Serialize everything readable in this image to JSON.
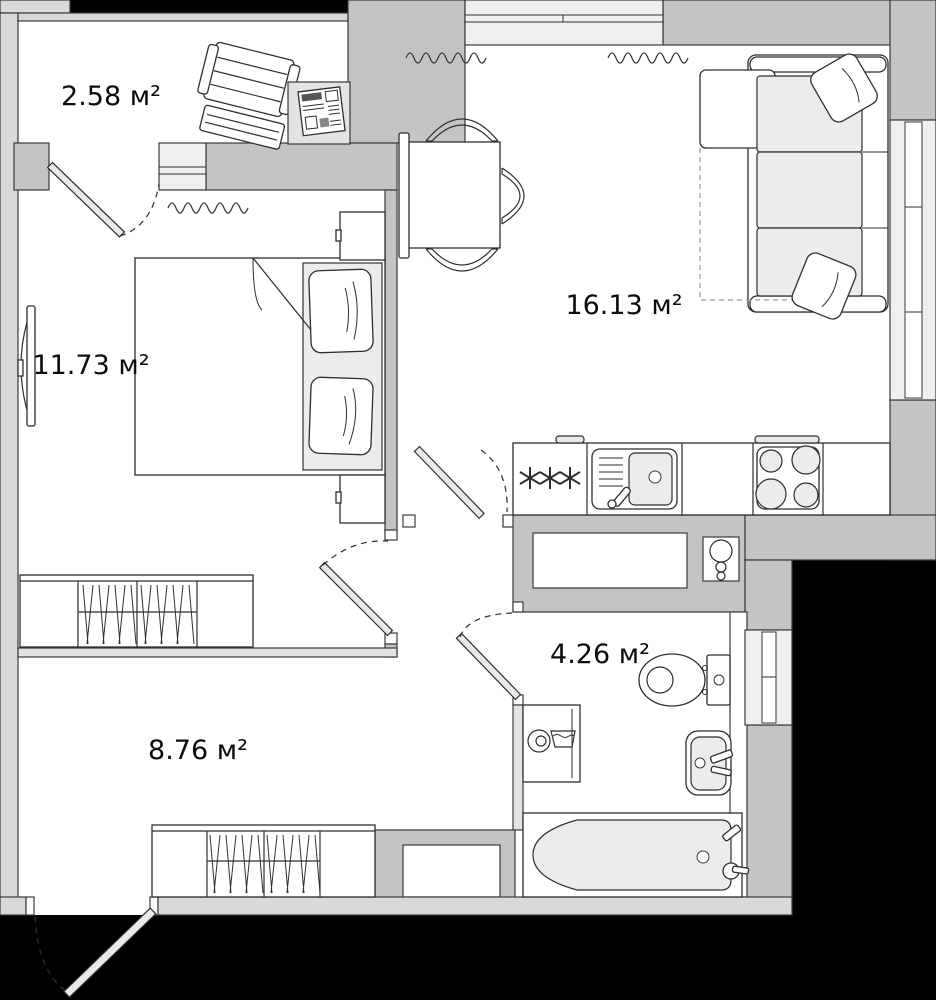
{
  "plan": {
    "type": "apartment-floor-plan",
    "unit": "м²",
    "rooms": [
      {
        "name": "balcony",
        "area": "2.58",
        "label": "2.58 м²"
      },
      {
        "name": "bedroom",
        "area": "11.73",
        "label": "11.73 м²"
      },
      {
        "name": "living-kitchen",
        "area": "16.13",
        "label": "16.13 м²"
      },
      {
        "name": "bathroom",
        "area": "4.26",
        "label": "4.26 м²"
      },
      {
        "name": "hallway",
        "area": "8.76",
        "label": "8.76 м²"
      }
    ],
    "colors": {
      "wall": "#c4c4c4",
      "outer_wall": "#d9d9d9",
      "partition": "#e3e3e3",
      "floor": "#ffffff",
      "void": "#000000",
      "line": "#2e2e2e"
    },
    "icons": [
      "deck-chair-icon",
      "side-table-icon",
      "newspaper-icon",
      "bed-icon",
      "pillow-icon",
      "nightstand-icon",
      "tv-icon",
      "wardrobe-icon",
      "radiator-icon",
      "dining-table-icon",
      "chair-icon",
      "bench-icon",
      "sofa-icon",
      "fridge-icon",
      "kitchen-sink-icon",
      "stove-icon",
      "vent-icon",
      "toilet-icon",
      "washbasin-icon",
      "washing-machine-icon",
      "bathtub-icon",
      "door-swing-icon"
    ]
  }
}
